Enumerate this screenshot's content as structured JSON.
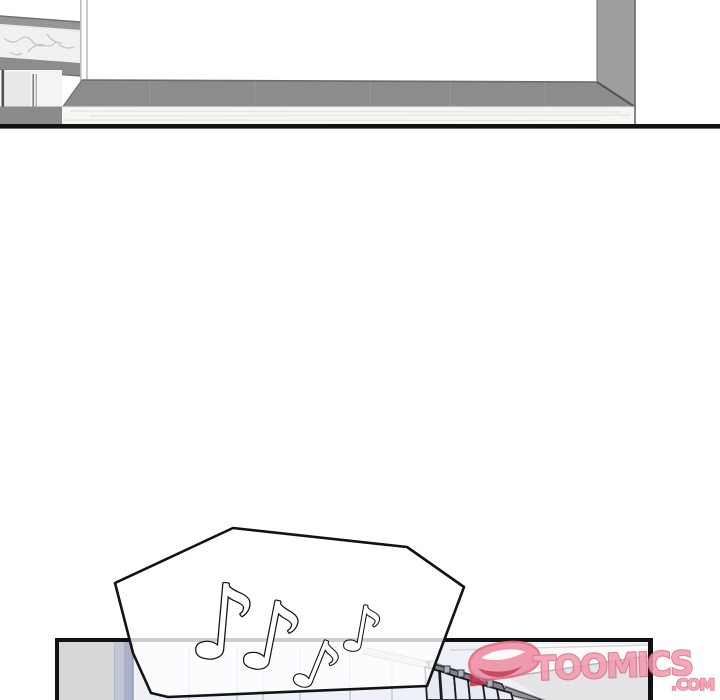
{
  "page": {
    "kind": "webtoon-comic-page",
    "background_color": "#ffffff"
  },
  "watermark": {
    "brand": "TOOMICS",
    "suffix": ".COM",
    "fill_color": "#f29aab",
    "outline_color": "#dc6b86",
    "mascot_accent_color": "#c13048"
  },
  "speech_bubble": {
    "content_type": "music-notes",
    "fill": "rgba(255,255,255,0.8)",
    "outline_color": "#131313",
    "glyphs": {
      "n1": "♪",
      "n2": "♪",
      "n3": "♪",
      "n4": "♪"
    }
  },
  "colors": {
    "floor_gray": "#8c8c8c",
    "column_gray": "#9e9e9e",
    "counter_band_gray": "#969696",
    "marble_white": "#f2f1ef",
    "panel_border_black": "#111111",
    "room_wall_gray": "#d6d7d9",
    "curtain_lavender": "#aab0c8",
    "curtain_sheet_blue": "#e6eaf5",
    "rail_dark_gray": "#7f828a"
  }
}
